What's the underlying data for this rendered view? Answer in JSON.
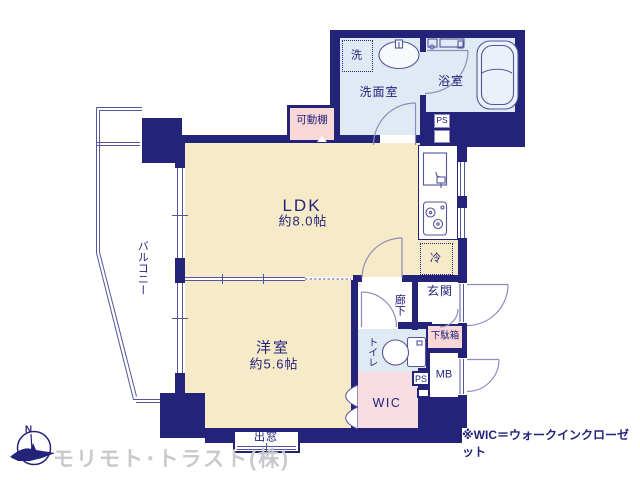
{
  "plan": {
    "rooms": {
      "balcony": {
        "label": "バルコニー"
      },
      "ldk": {
        "label": "LDK",
        "size": "約8.0帖"
      },
      "western_room": {
        "label": "洋室",
        "size": "約5.6帖"
      },
      "washroom": {
        "label": "洗面室"
      },
      "washer": {
        "label": "洗"
      },
      "bathroom": {
        "label": "浴室"
      },
      "movable_shelf": {
        "label": "可動棚"
      },
      "refrigerator": {
        "label": "冷"
      },
      "entrance": {
        "label": "玄関"
      },
      "hallway": {
        "label": "廊下"
      },
      "toilet": {
        "label": "トイレ"
      },
      "shoe_cabinet": {
        "label": "下駄箱"
      },
      "wic": {
        "label": "WIC"
      },
      "bay_window": {
        "label": "出窓"
      },
      "ps_upper": {
        "label": "PS"
      },
      "ps_lower": {
        "label": "PS"
      },
      "mb": {
        "label": "MB"
      }
    },
    "note": "※WIC＝ウォークインクローゼット",
    "company": "モリモト･トラスト(株)",
    "compass": {
      "label": "N"
    },
    "colors": {
      "wall": "#23237a",
      "room_beige": "#f7eac8",
      "wet_blue": "#dfeaf4",
      "storage_pink": "#f9d7d7",
      "wic_pink": "#f7dde2",
      "thin_line": "#55559a",
      "door_arc": "#8d8dbb",
      "company_gray": "#c9c9ce"
    }
  }
}
